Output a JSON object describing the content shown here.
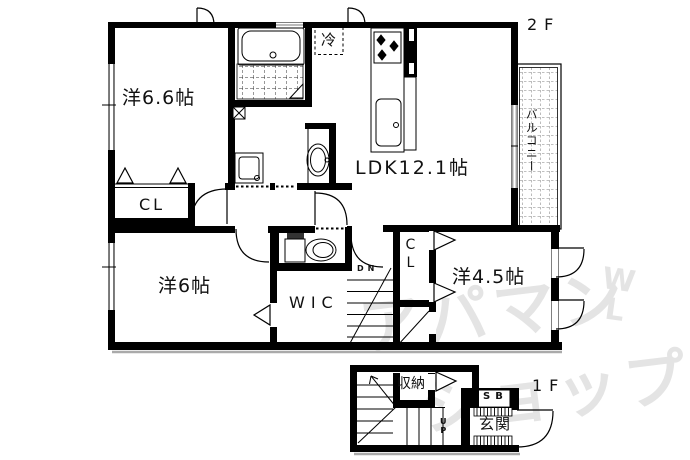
{
  "plan": {
    "labels": {
      "room_6_6": "洋6.6帖",
      "closet_6_6": "CL",
      "ldk": "LDK12.1帖",
      "room_6": "洋6帖",
      "wic": "WIC",
      "closet_4_5": "CL",
      "room_4_5": "洋4.5帖",
      "balcony": "バルコニー",
      "refrigerator": "冷",
      "stairs_down": "DN",
      "stairs_up": "UP",
      "storage": "収納",
      "shoe_box": "SB",
      "entrance": "玄関",
      "floor_2": "2F",
      "floor_1": "1F"
    },
    "watermark": {
      "line1": "アパマン",
      "line2": "ショップ",
      "logo_top": "W",
      "logo_bottom": "L"
    },
    "colors": {
      "wall": "#000000",
      "background": "#ffffff",
      "watermark": "#e4e4e4",
      "shadow": "#aaaaaa"
    }
  }
}
